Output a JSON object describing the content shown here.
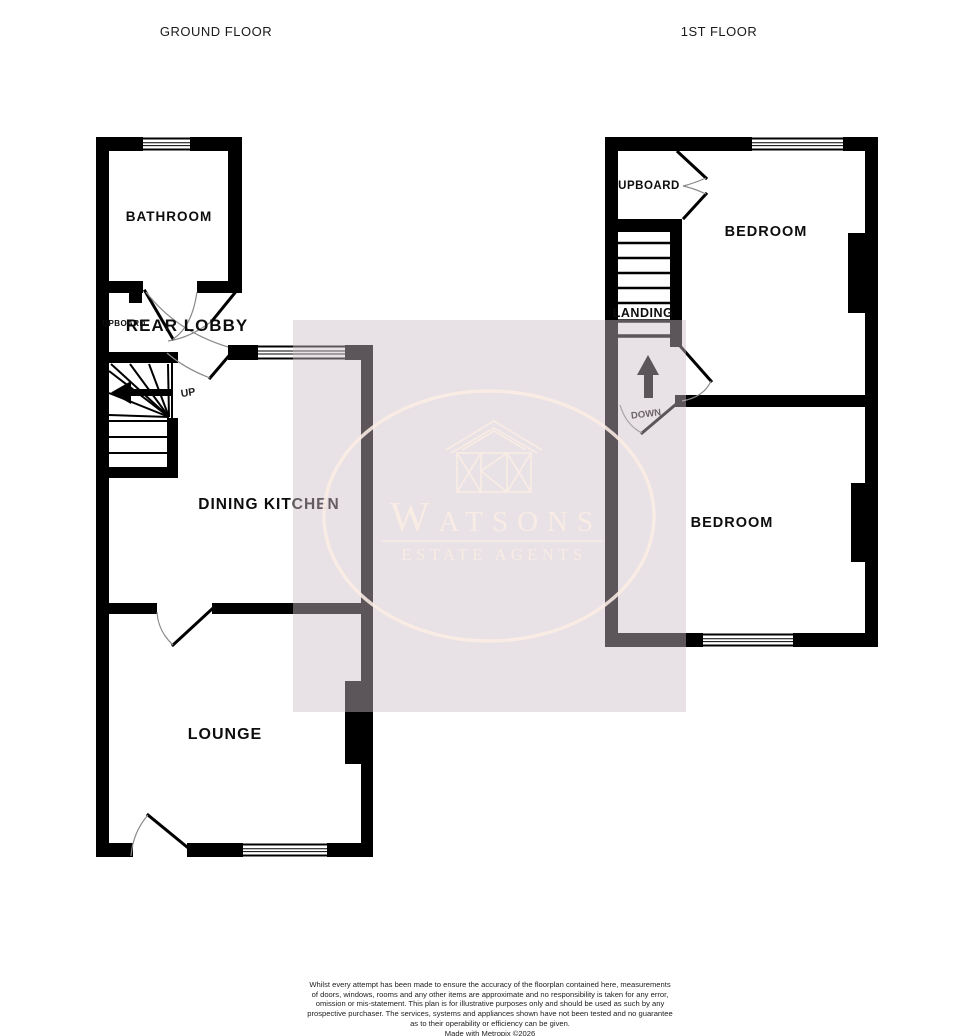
{
  "titles": {
    "ground_floor": "GROUND FLOOR",
    "first_floor": "1ST FLOOR"
  },
  "ground_floor": {
    "rooms": {
      "bathroom": "BATHROOM",
      "rear_lobby": "REAR LOBBY",
      "cupboard": "UPBOARD",
      "dining_kitchen": "DINING KITCHEN",
      "lounge": "LOUNGE"
    },
    "stairs": {
      "direction_label": "UP"
    }
  },
  "first_floor": {
    "rooms": {
      "cupboard": "UPBOARD",
      "bedroom_front": "BEDROOM",
      "landing": "LANDING",
      "bedroom_back": "BEDROOM"
    },
    "stairs": {
      "direction_label": "DOWN"
    }
  },
  "watermark": {
    "name": "Watsons",
    "tagline": "ESTATE AGENTS"
  },
  "footer": {
    "disclaimer_lines": [
      "Whilst every attempt has been made to ensure the accuracy of the floorplan contained here, measurements",
      "of doors, windows, rooms and any other items are approximate and no responsibility is taken for any error,",
      "omission or mis-statement. This plan is for illustrative purposes only and should be used as such by any",
      "prospective purchaser. The services, systems and appliances shown have not been tested and no guarantee",
      "as to their operability or efficiency can be given."
    ],
    "credit": "Made with Metropix ©2026"
  },
  "colors": {
    "wall": "#000000",
    "arc": "#8a8a8a",
    "ink": "#111111",
    "wm_bg": "rgba(203,188,197,0.45)",
    "wm_fg": "rgba(250,237,229,0.88)",
    "bg": "#ffffff"
  }
}
